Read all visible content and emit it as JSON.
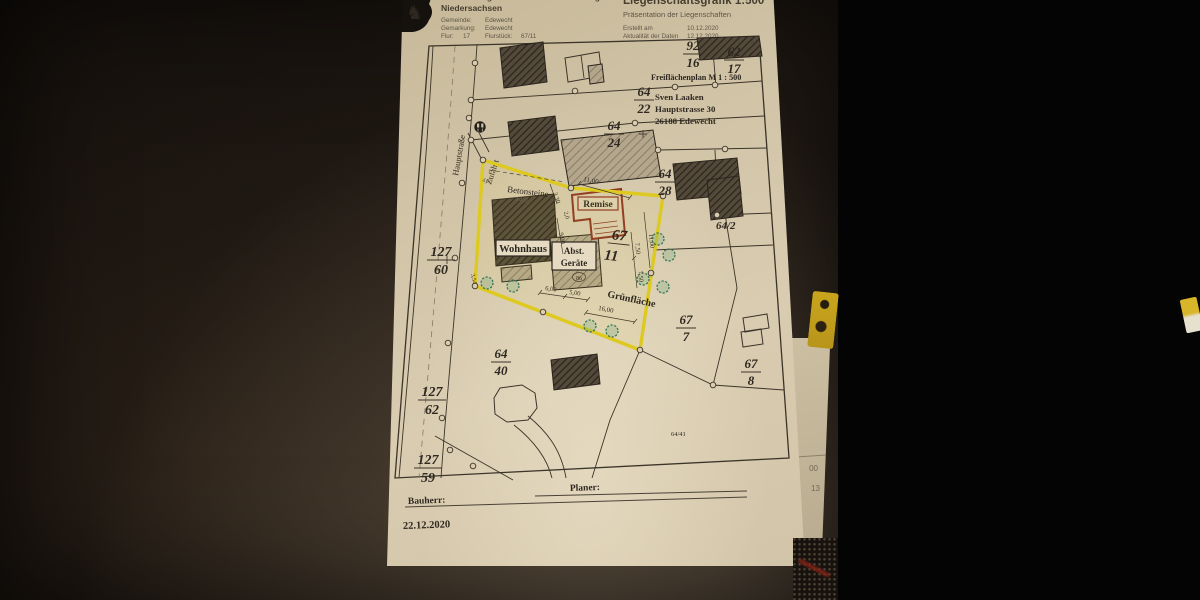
{
  "scene": {
    "plot_highlight_color": "#ddc91f",
    "remise_outline_color": "#8d3420",
    "tree_color": "#35765a",
    "paper_color": "#d3c6aa"
  },
  "header": {
    "agency_line1": "Vermessungs- und Katasterverwaltung",
    "agency_line2": "Niedersachsen",
    "logo_glyph": "♞",
    "gemeinde_label": "Gemeinde:",
    "gemeinde_value": "Edewecht",
    "gemarkung_label": "Gemarkung:",
    "gemarkung_value": "Edewecht",
    "flur_label": "Flur:",
    "flur_value": "17",
    "flurstueck_label": "Flurstück:",
    "flurstueck_value": "67/11",
    "title": "Liegenschaftsgrafik 1:500",
    "subtitle": "Präsentation der Liegenschaften",
    "created_label": "Erstellt am",
    "created_value": "10.12.2020",
    "updated_label": "Aktualität der Daten",
    "updated_value": "12.12.2020"
  },
  "map": {
    "plan_title": "Freiflächenplan  M 1 : 500",
    "owner": {
      "name": "Sven Laaken",
      "street": "Hauptstrasse 30",
      "city": "26188 Edewecht"
    },
    "street_name": "Hauptstraße",
    "access_label": "Zufahrt",
    "area_labels": {
      "betonsteine": "Betonsteine",
      "wohnhaus": "Wohnhaus",
      "remise": "Remise",
      "shed_line1": "Abst.",
      "shed_line2": "Geräte",
      "gruenflaeche": "Grünfläche"
    },
    "parcels": {
      "p92_16": {
        "num": "92",
        "den": "16"
      },
      "p62_17": {
        "num": "62",
        "den": "17"
      },
      "p64_22": {
        "num": "64",
        "den": "22"
      },
      "p64_24": {
        "num": "64",
        "den": "24"
      },
      "p64_28": {
        "num": "64",
        "den": "28"
      },
      "p64_2x": "64/2",
      "p67_11": {
        "num": "67",
        "den": "11"
      },
      "p67_7": {
        "num": "67",
        "den": "7"
      },
      "p67_8": {
        "num": "67",
        "den": "8"
      },
      "p64_40": {
        "num": "64",
        "den": "40"
      },
      "p64_41": "64/41",
      "p127_60": {
        "num": "127",
        "den": "60"
      },
      "p127_62": {
        "num": "127",
        "den": "62"
      },
      "p127_59": {
        "num": "127",
        "den": "59"
      }
    },
    "dims": {
      "top": "11,00",
      "right": "11,00",
      "a330": "3,30",
      "a20": "2,0",
      "a900": "9,00",
      "b750": "7,50",
      "c750": "7,50",
      "a600": "6,00",
      "a500": "5,00",
      "a1600": "16,00",
      "hw40": "4,0",
      "hw140": "14,0",
      "a354": "3,54",
      "pt86": "86"
    }
  },
  "footer": {
    "bauherr_label": "Bauherr:",
    "planer_label": "Planer:",
    "date": "22.12.2020"
  },
  "side_sheet": {
    "num1": "00",
    "num2": "13"
  }
}
